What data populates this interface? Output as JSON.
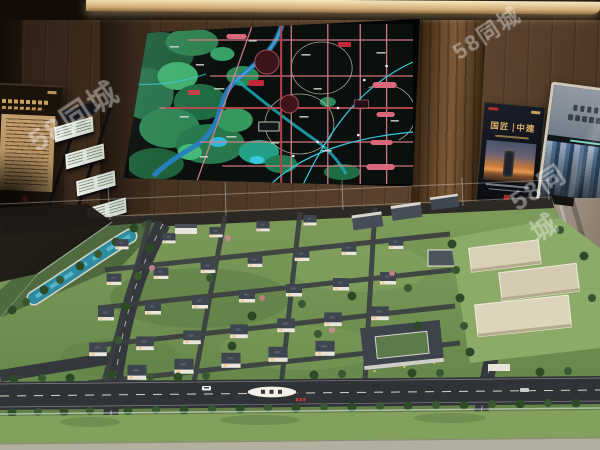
{
  "watermark": {
    "text": "58同城"
  },
  "brand_poster": {
    "title_left": "国匠",
    "title_right": "中建"
  },
  "colors": {
    "wood_brown": "#543c2a",
    "cove_light": "#f6e9c2",
    "map_terrain_green": "#2e8050",
    "map_road_pink": "#e2808e",
    "map_metro_cyan": "#38c8dc",
    "map_label_red": "#c22838",
    "model_grass": "#7c9a58",
    "model_water": "#2f8ca0",
    "villa_roof": "#3f454e",
    "villa_wall": "#e9e6dd",
    "poster_gold": "#d8b06a"
  }
}
